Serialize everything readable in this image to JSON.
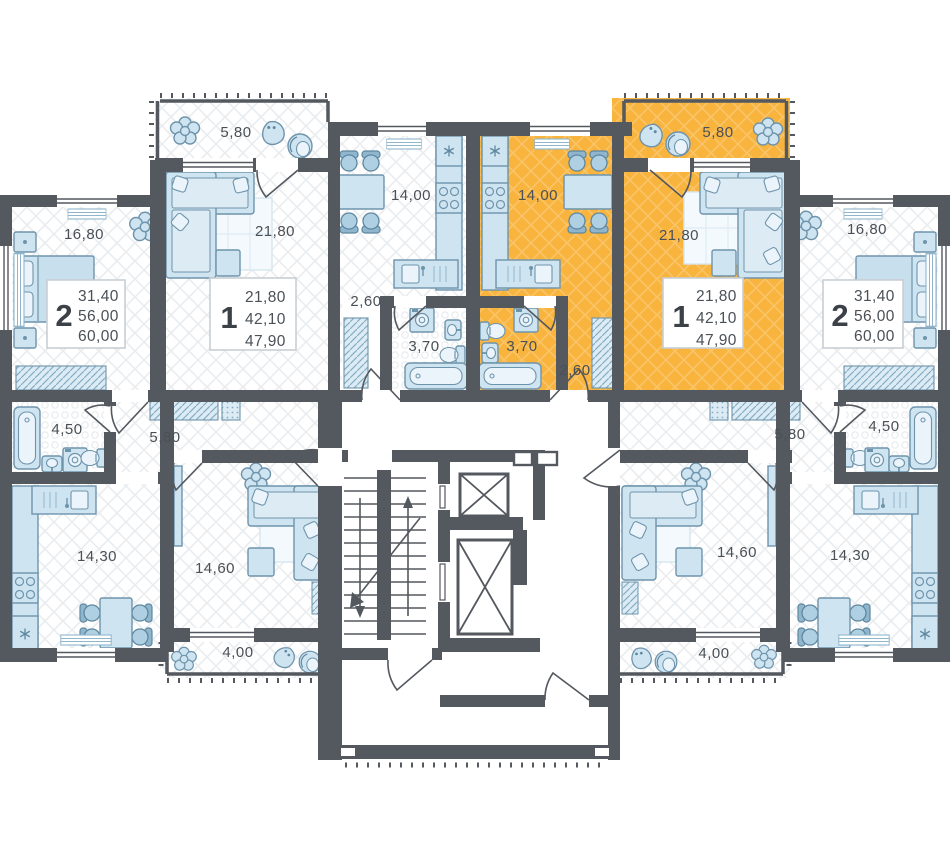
{
  "colors": {
    "highlight": "#F8B43D",
    "wall": "#54585F",
    "fur": "#CFE4F1",
    "furstroke": "#6E94AC",
    "text": "#4A5056"
  },
  "cards": [
    {
      "rooms": "2",
      "line1": "31,40",
      "line2": "56,00",
      "line3": "60,00"
    },
    {
      "rooms": "1",
      "line1": "21,80",
      "line2": "42,10",
      "line3": "47,90"
    },
    {
      "rooms": "1",
      "line1": "21,80",
      "line2": "42,10",
      "line3": "47,90"
    },
    {
      "rooms": "2",
      "line1": "31,40",
      "line2": "56,00",
      "line3": "60,00"
    }
  ],
  "labels": {
    "tl_bedroom": "16,80",
    "tr_bedroom": "16,80",
    "l1_balcony": "5,80",
    "l1_living": "21,80",
    "l1_kitchen": "14,00",
    "l1_hall": "2,60",
    "l1_bath": "3,70",
    "r1_balcony": "5,80",
    "r1_living": "21,80",
    "r1_kitchen": "14,00",
    "r1_hall": "2,60",
    "r1_bath": "3,70",
    "bl_bath": "4,50",
    "bl_hall": "5,80",
    "bl_kitchen": "14,30",
    "bl_living": "14,60",
    "bl_balcony": "4,00",
    "br_bath": "4,50",
    "br_hall": "5,80",
    "br_kitchen": "14,30",
    "br_living": "14,60",
    "br_balcony": "4,00"
  }
}
